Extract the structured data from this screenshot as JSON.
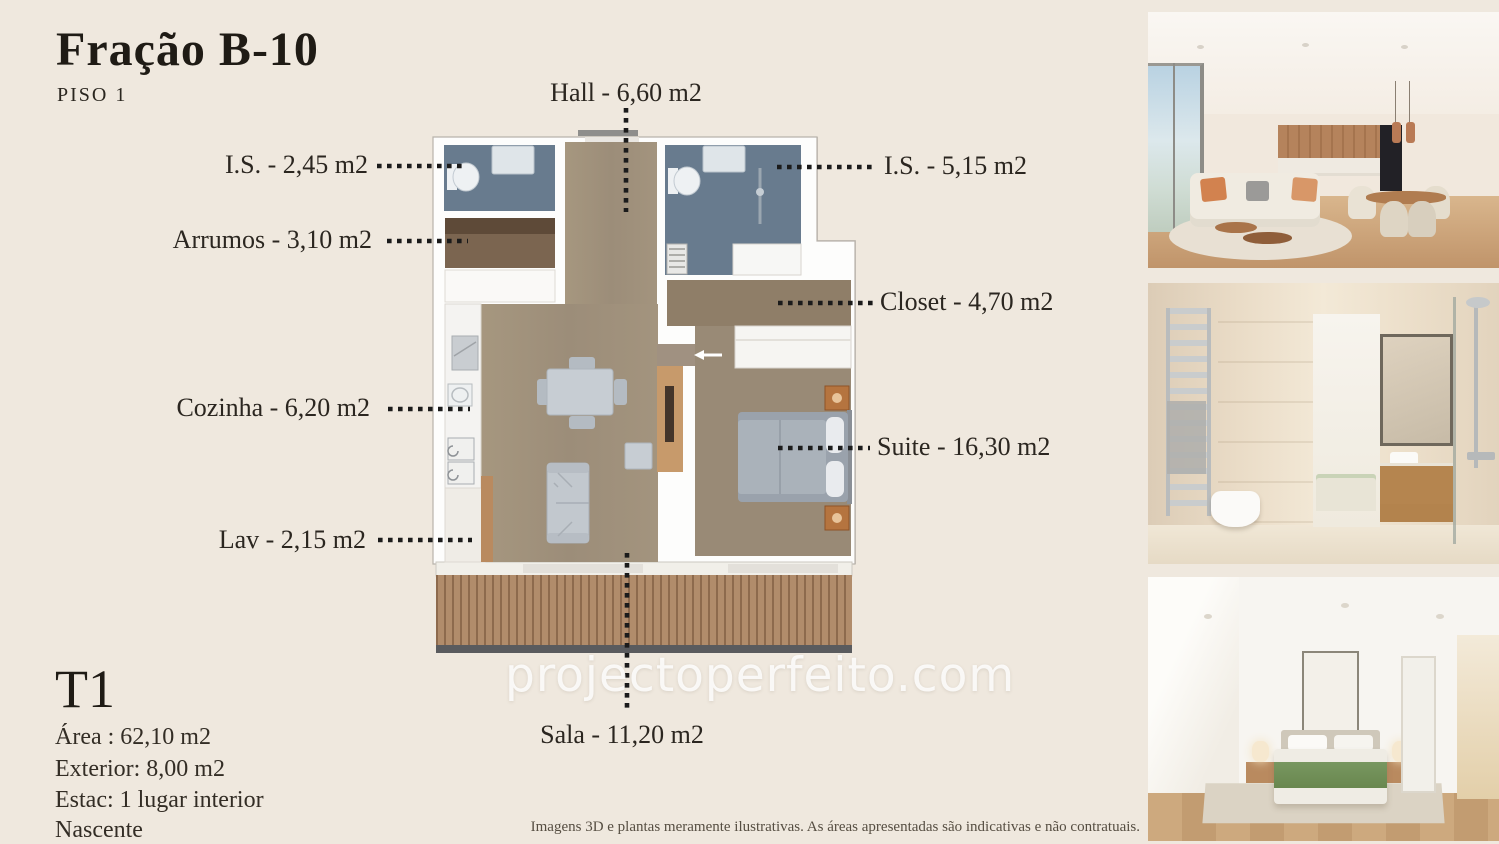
{
  "page": {
    "title": "Fração B-10",
    "subtitle": "PISO 1",
    "watermark": "projectoperfeito.com",
    "disclaimer": "Imagens 3D e plantas meramente ilustrativas. As áreas apresentadas são indicativas e não contratuais.",
    "background_color": "#efe8de",
    "text_color": "#2b2620",
    "leader_line_color": "#1b1b1b"
  },
  "unit_details": {
    "typology": "T1",
    "lines": [
      "Área : 62,10 m2",
      "Exterior: 8,00 m2",
      "Estac: 1 lugar interior",
      "Nascente"
    ]
  },
  "floorplan_labels": {
    "hall": "Hall - 6,60 m2",
    "is_small": "I.S. - 2,45 m2",
    "arrumos": "Arrumos - 3,10 m2",
    "cozinha": "Cozinha - 6,20 m2",
    "lav": "Lav - 2,15 m2",
    "is_large": "I.S. - 5,15 m2",
    "closet": "Closet - 4,70 m2",
    "suite": "Suite - 16,30 m2",
    "sala": "Sala - 11,20 m2"
  },
  "floorplan_colors": {
    "wood_floor": "#a29380",
    "bathroom_tile": "#687b8e",
    "storage_floor": "#7b6550",
    "deck": "#b18c6b",
    "walls": "#fdfdfc",
    "tv_wall_wood": "#c79a6b",
    "nightstand": "#b5743f"
  },
  "photos": [
    {
      "name": "living-room-3d-render"
    },
    {
      "name": "bathroom-3d-render"
    },
    {
      "name": "bedroom-3d-render"
    }
  ]
}
